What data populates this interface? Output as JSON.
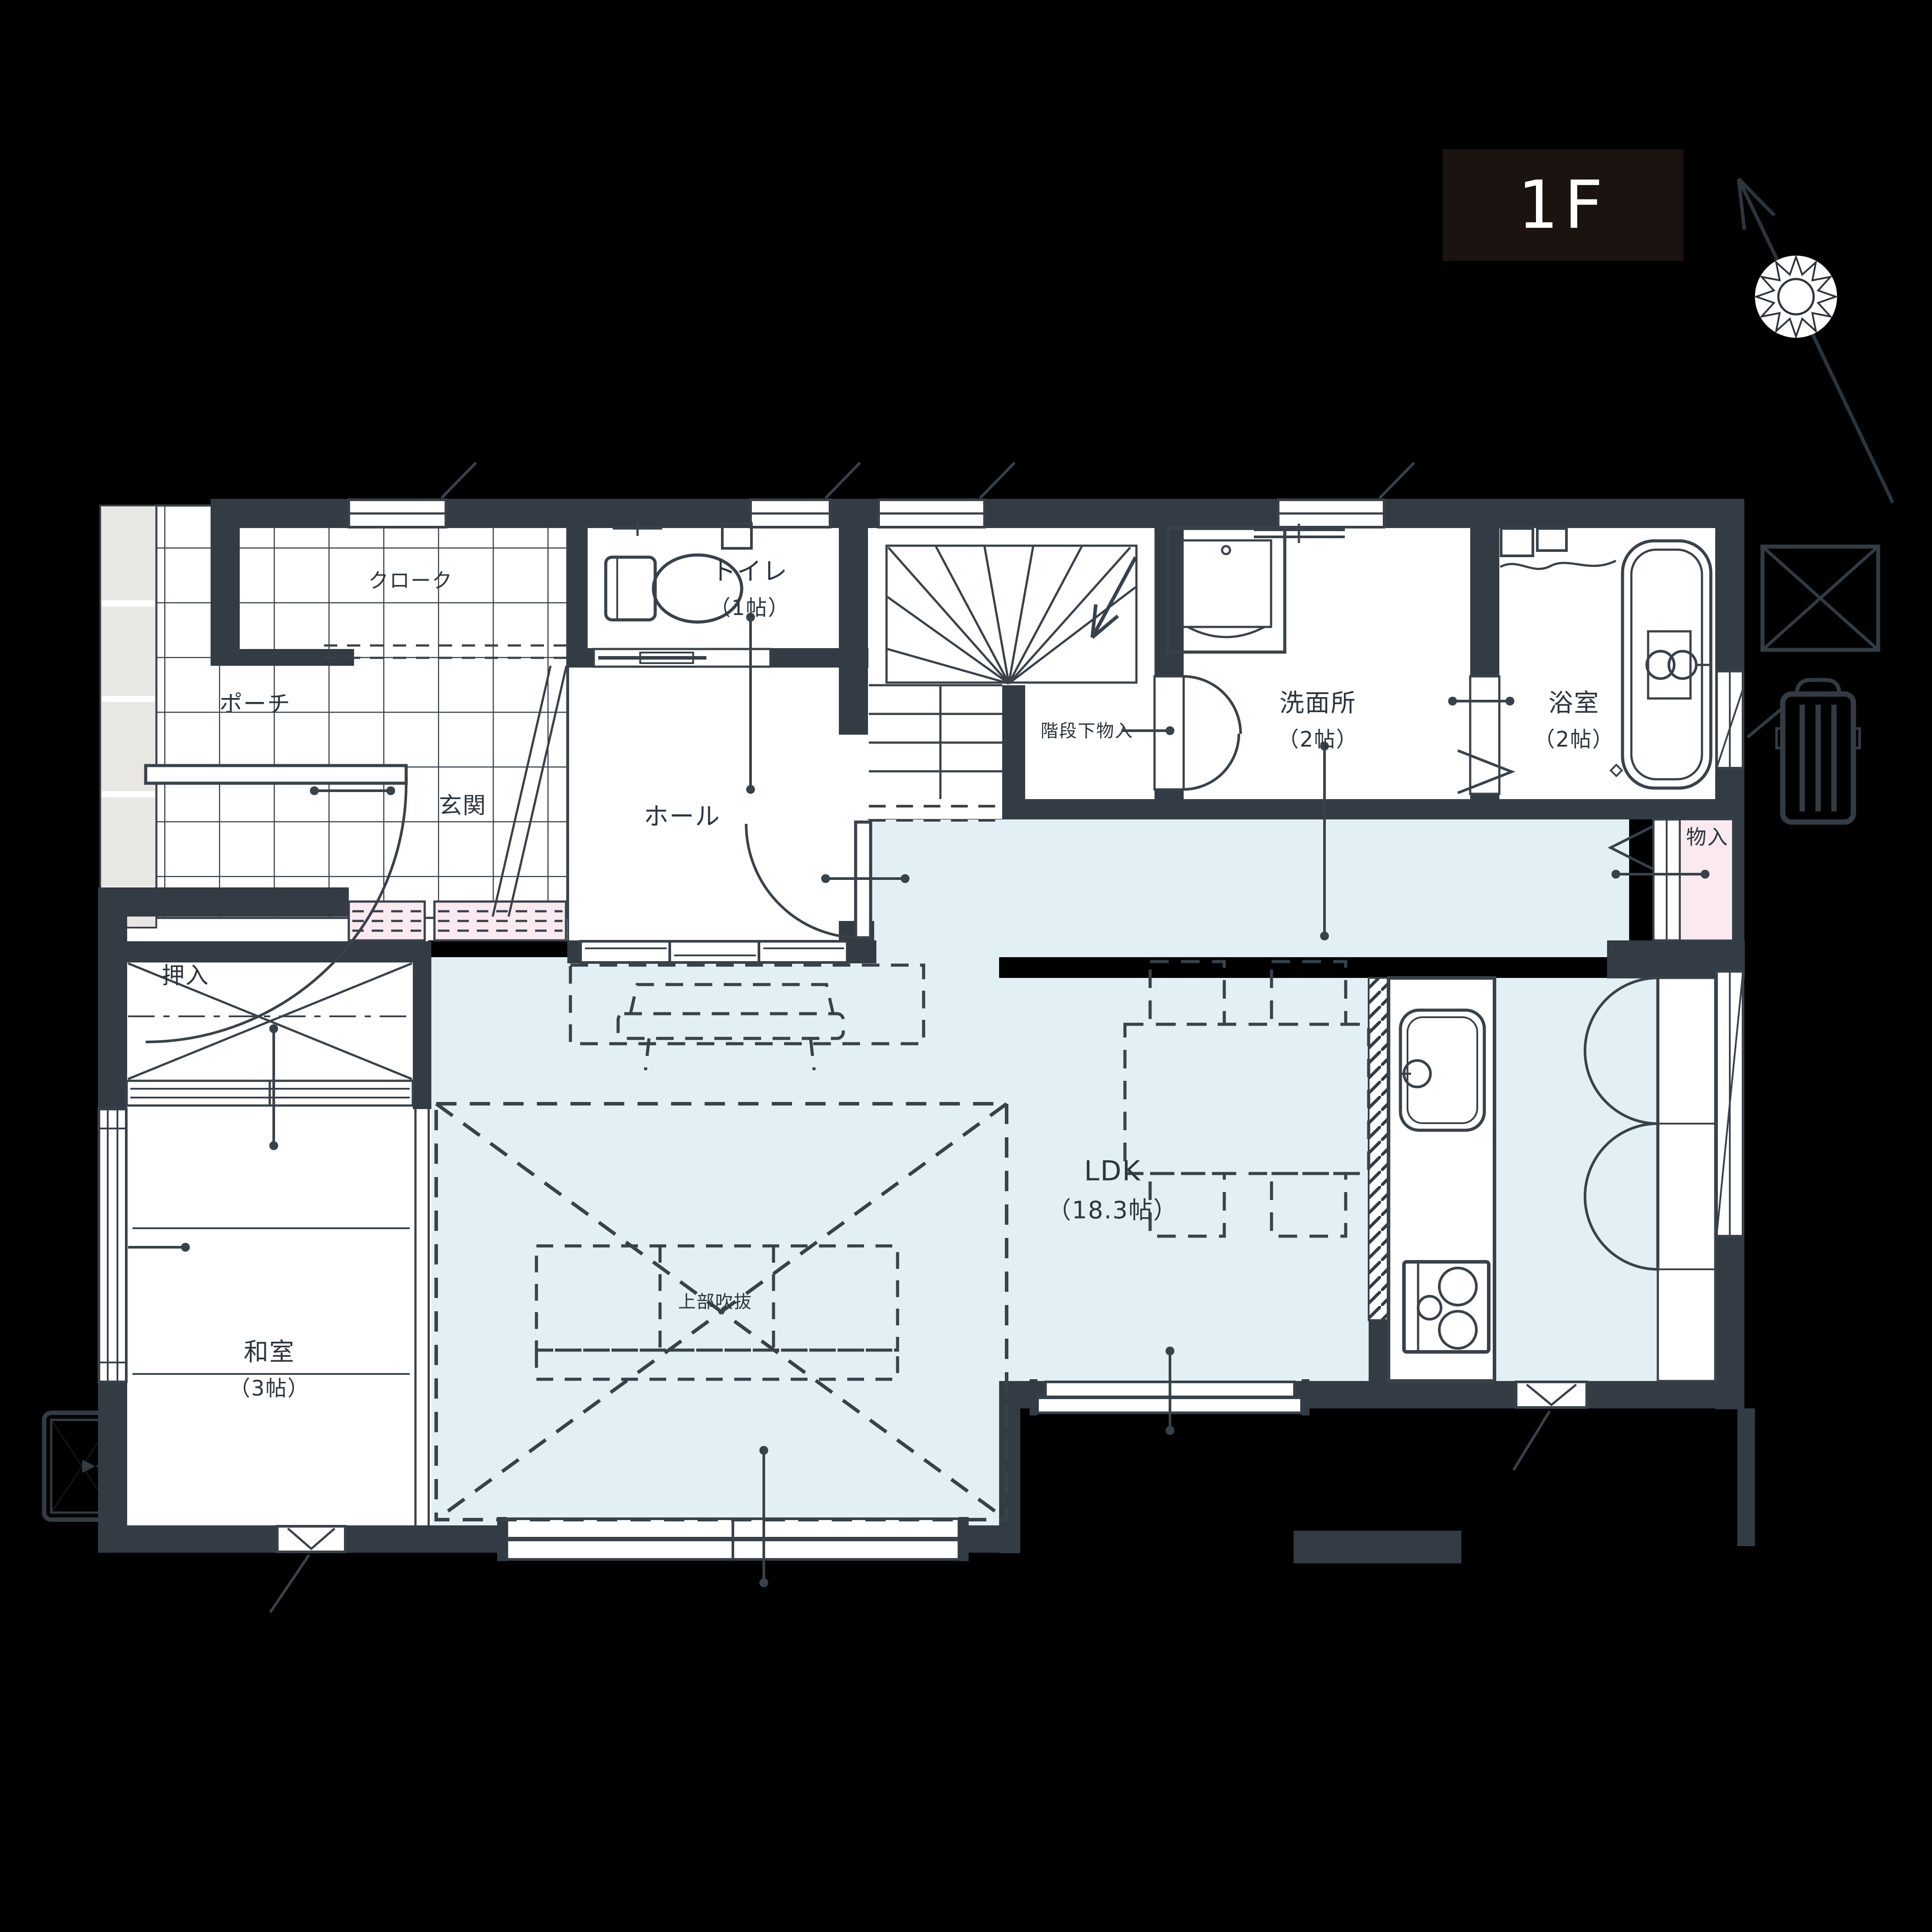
{
  "floor_badge": {
    "label": "1F",
    "bg": "#1a1310",
    "fg": "#ffffff"
  },
  "palette": {
    "background": "#000000",
    "wall": "#333b44",
    "line": "#39414a",
    "ldk_fill": "#e2f0f6",
    "pink_fill": "#fbe9f0",
    "gray_fill": "#e9e7e3",
    "paper": "#ffffff"
  },
  "rooms": {
    "cloak": {
      "label": "クローク"
    },
    "toilet": {
      "label": "トイレ",
      "size": "（1帖）"
    },
    "porch": {
      "label": "ポーチ"
    },
    "entrance": {
      "label": "玄関"
    },
    "hall": {
      "label": "ホール"
    },
    "under_stair_storage": {
      "label": "階段下物入"
    },
    "washroom": {
      "label": "洗面所",
      "size": "（2帖）"
    },
    "bathroom": {
      "label": "浴室",
      "size": "（2帖）"
    },
    "storage": {
      "label": "物入"
    },
    "closet": {
      "label": "押入"
    },
    "japanese_room": {
      "label": "和室",
      "size": "（3帖）"
    },
    "ldk": {
      "label": "LDK",
      "size": "（18.3帖）"
    },
    "void_above": {
      "label": "上部吹抜"
    }
  }
}
